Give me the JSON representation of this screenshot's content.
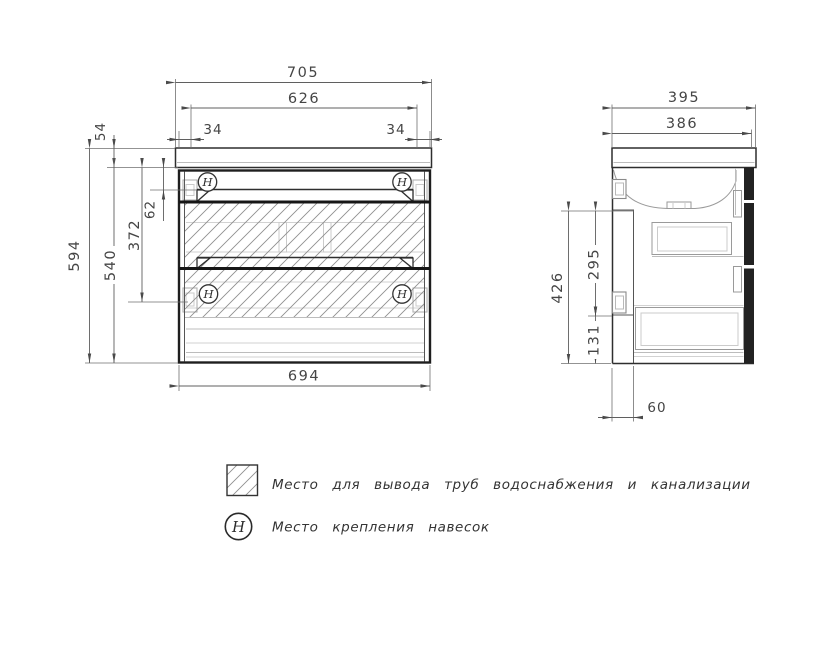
{
  "drawing": {
    "front_view": {
      "dim_width_overall": "705",
      "dim_mount_span": "626",
      "dim_mount_offset_left": "34",
      "dim_mount_offset_right": "34",
      "dim_countertop_thickness": "54",
      "dim_height_overall": "594",
      "dim_cabinet_height": "540",
      "dim_top_section": "62",
      "dim_mount_drop": "372",
      "dim_cabinet_width": "694",
      "hanger_symbol": "H"
    },
    "side_view": {
      "dim_depth_overall": "395",
      "dim_depth_body": "386",
      "dim_service_total": "426",
      "dim_service_upper": "295",
      "dim_service_lower": "131",
      "dim_service_depth": "60"
    },
    "legend": {
      "items": [
        {
          "symbol": "hatch",
          "label": "Место для вывода труб водоснабжения и канализации"
        },
        {
          "symbol": "H",
          "label": "Место крепления навесок"
        }
      ]
    },
    "colors": {
      "outline": "#1e1e1e",
      "dimension": "#454545",
      "hatch": "#8f8f8f"
    }
  }
}
